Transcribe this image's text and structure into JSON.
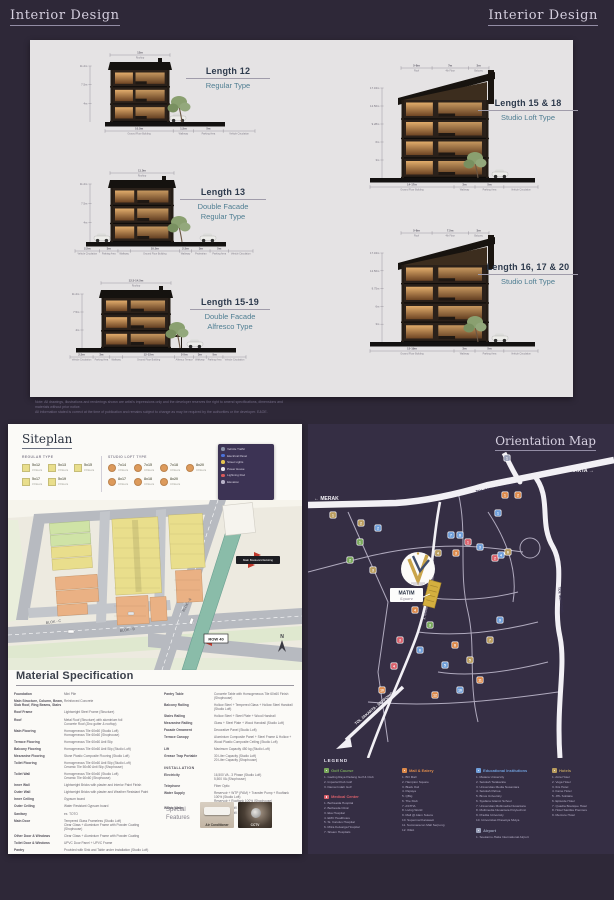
{
  "page": {
    "header_left": "Interior Design",
    "header_right": "Interior Design"
  },
  "interior": {
    "sections": [
      {
        "id": "length-12",
        "title": "Length 12",
        "subtitle": "Regular Type",
        "floors": 3,
        "style": "regular",
        "top_dims": [
          {
            "v": "12m",
            "l": "Rooftop",
            "w": 1
          }
        ],
        "heights": [
          "11.2m",
          "7.5m",
          "4m"
        ],
        "bottom_dims": [
          {
            "v": "10.5m",
            "l": "Ground Floor Building",
            "w": 3
          },
          {
            "v": "1.5m",
            "l": "Walkway",
            "w": 0.9
          },
          {
            "v": "5m",
            "l": "Parking Area",
            "w": 1.3
          },
          {
            "v": "",
            "l": "Vehicle Circulation",
            "w": 1.4
          }
        ]
      },
      {
        "id": "length-13",
        "title": "Length 13",
        "subtitle": "Double Facade\nRegular Type",
        "floors": 3,
        "style": "double",
        "top_dims": [
          {
            "v": "11.5m",
            "l": "Rooftop",
            "w": 1
          }
        ],
        "heights": [
          "11.2m",
          "7.5m",
          "4m"
        ],
        "bottom_dims": [
          {
            "v": "2.5m",
            "l": "Vehicle Circulation",
            "w": 1.2
          },
          {
            "v": "3m",
            "l": "Parking Area",
            "w": 0.9
          },
          {
            "v": "",
            "l": "Walkway",
            "w": 0.6
          },
          {
            "v": "10.5m",
            "l": "Ground Floor Building",
            "w": 2.4
          },
          {
            "v": "2.5m",
            "l": "Walkway",
            "w": 0.6
          },
          {
            "v": "3m",
            "l": "Pedestrian",
            "w": 0.9
          },
          {
            "v": "5m",
            "l": "Parking Area",
            "w": 0.9
          },
          {
            "v": "",
            "l": "Vehicle Circulation",
            "w": 1.2
          }
        ]
      },
      {
        "id": "length-15-19",
        "title": "Length 15-19",
        "subtitle": "Double Facade\nAlfresco Type",
        "floors": 3,
        "style": "alfresco",
        "top_dims": [
          {
            "v": "12.5-14.5m",
            "l": "Rooftop",
            "w": 1
          }
        ],
        "heights": [
          "11.2m",
          "7.5m",
          "4m"
        ],
        "bottom_dims": [
          {
            "v": "2.5m",
            "l": "Vehicle Circulation",
            "w": 1.1
          },
          {
            "v": "3m",
            "l": "Parking Area",
            "w": 0.8
          },
          {
            "v": "",
            "l": "Walkway",
            "w": 0.6
          },
          {
            "v": "12-15m",
            "l": "Ground Floor Building",
            "w": 2.5
          },
          {
            "v": "2-5m",
            "l": "Alfresco Terrace",
            "w": 0.9
          },
          {
            "v": "3m",
            "l": "Walkway",
            "w": 0.6
          },
          {
            "v": "5m",
            "l": "Parking Area",
            "w": 0.8
          },
          {
            "v": "",
            "l": "Vehicle Circulation",
            "w": 1.1
          }
        ]
      },
      {
        "id": "length-15-18",
        "title": "Length 15 & 18",
        "subtitle": "Studio Loft Type",
        "floors": 4,
        "style": "studio",
        "top_dims": [
          {
            "v": "5-8m",
            "l": "Roof",
            "w": 1.2
          },
          {
            "v": "7m",
            "l": "4th Floor",
            "w": 1.4
          },
          {
            "v": "3m",
            "l": "Balcony",
            "w": 0.8
          }
        ],
        "heights": [
          "17.34m",
          "12.56m",
          "9.28m",
          "6m",
          "3m"
        ],
        "bottom_dims": [
          {
            "v": "14-17m",
            "l": "Ground Floor Building",
            "w": 3.2
          },
          {
            "v": "3m",
            "l": "Walkway",
            "w": 0.8
          },
          {
            "v": "5m",
            "l": "Parking Area",
            "w": 1.1
          },
          {
            "v": "",
            "l": "Vehicle Circulation",
            "w": 1.3
          }
        ]
      },
      {
        "id": "length-16-17-20",
        "title": "Length 16, 17 & 20",
        "subtitle": "Studio Loft Type",
        "floors": 4,
        "style": "studio",
        "top_dims": [
          {
            "v": "5-8m",
            "l": "Roof",
            "w": 1.2
          },
          {
            "v": "7.5m",
            "l": "4th Floor",
            "w": 1.4
          },
          {
            "v": "3m",
            "l": "Balcony",
            "w": 0.8
          }
        ],
        "heights": [
          "17.34m",
          "12.56m",
          "9.75m",
          "6m",
          "3m"
        ],
        "bottom_dims": [
          {
            "v": "15-19m",
            "l": "Ground Floor Building",
            "w": 3.2
          },
          {
            "v": "3m",
            "l": "Walkway",
            "w": 0.8
          },
          {
            "v": "5m",
            "l": "Parking Area",
            "w": 1.1
          },
          {
            "v": "",
            "l": "Vehicle Circulation",
            "w": 1.3
          }
        ]
      }
    ],
    "disclaimer": "Note: All drawings, illustrations and renderings shown are artist's impressions only and the developer reserves the right to amend specifications, dimensions and materials without prior notice.\nAll information stated is correct at the time of publication and remains subject to change as may be required by the authorities or the developer. E&OE."
  },
  "siteplan": {
    "title": "Siteplan",
    "regular_type": {
      "label": "REGULAR TYPE",
      "color": "#e9de8c",
      "items": [
        {
          "code": "5x12",
          "floors": "3 Floors"
        },
        {
          "code": "5x13",
          "floors": "3 Floors"
        },
        {
          "code": "5x15",
          "floors": "3 Floors"
        },
        {
          "code": "5x17",
          "floors": "3 Floors"
        },
        {
          "code": "5x19",
          "floors": "3 Floors"
        }
      ]
    },
    "studio_type": {
      "label": "STUDIO LOFT TYPE",
      "color": "#dd9a5b",
      "items": [
        {
          "code": "7x14",
          "floors": "4 Floors"
        },
        {
          "code": "7x15",
          "floors": "4 Floors"
        },
        {
          "code": "7x18",
          "floors": "4 Floors"
        },
        {
          "code": "8x20",
          "floors": "4 Floors"
        },
        {
          "code": "8x17",
          "floors": "4 Floors"
        },
        {
          "code": "8x18",
          "floors": "4 Floors"
        },
        {
          "code": "8x20",
          "floors": "4 Floors"
        }
      ]
    },
    "site_key": [
      {
        "label": "Vehicle Traffic",
        "color": "#8a93a8"
      },
      {
        "label": "Electrical Panel",
        "color": "#4a72d8"
      },
      {
        "label": "Street Lights",
        "color": "#e5c44f"
      },
      {
        "label": "Power House",
        "color": "#e8e6ee"
      },
      {
        "label": "Lightning Rod",
        "color": "#d85a5a"
      },
      {
        "label": "Elevation",
        "color": "#b8b2c8"
      }
    ],
    "map_labels": {
      "blok_a": "BLOK - A",
      "blok_b": "BLOK - B",
      "blok_c": "BLOK - C",
      "row": "ROW 40",
      "boulevard": "Main Boulevard Existing",
      "north": "N"
    }
  },
  "material_spec": {
    "title": "Material Specification",
    "left_rows": [
      {
        "label": "Foundation",
        "value": "Mini Pile"
      },
      {
        "label": "Main Structure, Column, Beam, Slab Roof, Ring Beams, Stairs",
        "value": "Reinforced Concrete"
      },
      {
        "label": "Roof Frame",
        "value": "Lightweight Steel Frame (Structure)"
      },
      {
        "label": "Roof",
        "value": "Metal Roof (Structure) with aluminium foil\nConcrete Roof (Zinc gutter & rooftop)"
      },
      {
        "label": "Main Flooring",
        "value": "Homogeneous Tile 60x60 (Studio Loft)\nHomogeneous Tile 60x60 (Shophouse)"
      },
      {
        "label": "Terrace Flooring",
        "value": "Homogeneous Tile 60x60 Anti Slip"
      },
      {
        "label": "Balcony Flooring",
        "value": "Homogeneous Tile 60x60 Anti Slip (Studio Loft)"
      },
      {
        "label": "Mezzanine Flooring",
        "value": "Stone Plastic Composite Flooring (Studio Loft)"
      },
      {
        "label": "Toilet Flooring",
        "value": "Homogeneous Tile 60x60 Anti Slip (Studio Loft)\nCeramic Tile 50x50 Anti Slip (Shophouse)"
      },
      {
        "label": "Toilet Wall",
        "value": "Homogeneous Tile 60x60 (Studio Loft)\nCeramic Tile 60x60 (Shophouse)"
      },
      {
        "label": "Inner Wall",
        "value": "Lightweight Bricks with plaster and Interior Paint Finish"
      },
      {
        "label": "Outer Wall",
        "value": "Lightweight Bricks with plaster and Weather Resistant Paint"
      },
      {
        "label": "Inner Ceiling",
        "value": "Gypsum board"
      },
      {
        "label": "Outer Ceiling",
        "value": "Water Resistant Gypsum board"
      },
      {
        "label": "Sanitary",
        "value": "ex. TOTO"
      },
      {
        "label": "Main Door",
        "value": "Tempered Glass Frameless (Studio Loft)\nClear Glass + Aluminium Frame with Powder Coating (Shophouse)"
      },
      {
        "label": "Other Door & Windows",
        "value": "Clear Glass + Aluminium Frame with Powder Coating"
      },
      {
        "label": "Toilet Door & Windows",
        "value": "UPVC Door Panel + UPVC Frame"
      },
      {
        "label": "Pantry",
        "value": "Provided with Sink and Table under Installation (Studio Loft)"
      }
    ],
    "right_rows": [
      {
        "label": "Pantry Table",
        "value": "Concrete Table with Homogeneous Tile 60x60 Finish (Shophouse)"
      },
      {
        "label": "Balcony Railing",
        "value": "Hollow Steel + Tempered Glass + Hollow Steel Handrail (Studio Loft)"
      },
      {
        "label": "Stairs Railing",
        "value": "Hollow Steel + Steel Plate + Wood Handrail"
      },
      {
        "label": "Mezzanine Railing",
        "value": "Glass + Steel Plate + Wood Handrail (Studio Loft)"
      },
      {
        "label": "Facade Ornament",
        "value": "Decorative Panel (Studio Loft)"
      },
      {
        "label": "Terrace Canopy",
        "value": "Aluminium Composite Panel + Steel Frame & Hollow + Wood Plastic Composite Ceiling (Studio Loft)"
      },
      {
        "label": "Lift",
        "value": "Maximum Capacity 450 kg (Studio Loft)"
      },
      {
        "label": "Grease Trap Portable",
        "value": "30 Liter Capacity (Studio Loft)\n20 Liter Capacity (Shophouse)"
      },
      {
        "header": "INSTALLATION"
      },
      {
        "label": "Electricity",
        "value": "16,500 VA - 3 Phase (Studio Loft)\n5,500 VA (Shophouse)"
      },
      {
        "label": "Telephone",
        "value": "Fiber Optic"
      },
      {
        "label": "Water Supply",
        "value": "Reservoir + WTP (PAM) + Transfer Pump + Rooftank 100% (Studio Loft)\nReservoir + Rooftank 100% (Shophouse)"
      },
      {
        "label": "Waste Water",
        "value": "Septictank Biofil 100% (Studio Loft)\nSeptictank Biofil 100% (Shophouse)"
      }
    ],
    "special": {
      "label": "Special Features",
      "items": [
        {
          "caption": "Air Conditioner"
        },
        {
          "caption": "CCTV"
        }
      ]
    }
  },
  "orientation": {
    "title": "Orientation Map",
    "road_labels": {
      "merak": "← MERAK",
      "jakarta": "JAKARTA →",
      "tol_main": "TOL JAKARTA - MERAK",
      "tol_right": "TOL SERPONG",
      "tol_bottom": "TOL JAKARTA - SERPONG",
      "boulevard": "JL. GADING SERPONG BOULEVARD"
    },
    "site": {
      "name": "MATIM",
      "sub": "Square"
    },
    "legend_title": "LEGEND",
    "pin_colors": {
      "golf": "#79a85c",
      "med": "#d9606b",
      "mall": "#dd8a4b",
      "edu": "#6f9ed9",
      "hotel": "#b99c5e",
      "misc": "#9aa0b8"
    },
    "pins": [
      {
        "x": 25,
        "y": 63,
        "c": "hotel",
        "n": "1"
      },
      {
        "x": 53,
        "y": 71,
        "c": "hotel",
        "n": "2"
      },
      {
        "x": 70,
        "y": 76,
        "c": "edu",
        "n": "2"
      },
      {
        "x": 52,
        "y": 90,
        "c": "golf",
        "n": "1"
      },
      {
        "x": 65,
        "y": 118,
        "c": "hotel",
        "n": "3"
      },
      {
        "x": 42,
        "y": 108,
        "c": "golf",
        "n": "2"
      },
      {
        "x": 130,
        "y": 101,
        "c": "hotel",
        "n": "4"
      },
      {
        "x": 143,
        "y": 83,
        "c": "edu",
        "n": "7"
      },
      {
        "x": 152,
        "y": 83,
        "c": "edu",
        "n": "8"
      },
      {
        "x": 148,
        "y": 101,
        "c": "mall",
        "n": "3"
      },
      {
        "x": 160,
        "y": 90,
        "c": "med",
        "n": "1"
      },
      {
        "x": 172,
        "y": 95,
        "c": "edu",
        "n": "3"
      },
      {
        "x": 187,
        "y": 106,
        "c": "med",
        "n": "2"
      },
      {
        "x": 193,
        "y": 103,
        "c": "edu",
        "n": "4"
      },
      {
        "x": 200,
        "y": 100,
        "c": "hotel",
        "n": "6"
      },
      {
        "x": 190,
        "y": 61,
        "c": "edu",
        "n": "1"
      },
      {
        "x": 197,
        "y": 43,
        "c": "mall",
        "n": "1"
      },
      {
        "x": 210,
        "y": 43,
        "c": "mall",
        "n": "2"
      },
      {
        "x": 199,
        "y": 6,
        "c": "misc",
        "n": "1"
      },
      {
        "x": 107,
        "y": 158,
        "c": "mall",
        "n": "4"
      },
      {
        "x": 122,
        "y": 173,
        "c": "golf",
        "n": "3"
      },
      {
        "x": 147,
        "y": 193,
        "c": "mall",
        "n": "8"
      },
      {
        "x": 162,
        "y": 208,
        "c": "hotel",
        "n": "5"
      },
      {
        "x": 137,
        "y": 213,
        "c": "edu",
        "n": "5"
      },
      {
        "x": 172,
        "y": 228,
        "c": "mall",
        "n": "11"
      },
      {
        "x": 112,
        "y": 198,
        "c": "edu",
        "n": "6"
      },
      {
        "x": 92,
        "y": 188,
        "c": "med",
        "n": "3"
      },
      {
        "x": 152,
        "y": 238,
        "c": "edu",
        "n": "10"
      },
      {
        "x": 182,
        "y": 188,
        "c": "hotel",
        "n": "7"
      },
      {
        "x": 192,
        "y": 168,
        "c": "edu",
        "n": "9"
      },
      {
        "x": 127,
        "y": 243,
        "c": "mall",
        "n": "12"
      },
      {
        "x": 86,
        "y": 214,
        "c": "med",
        "n": "4"
      },
      {
        "x": 74,
        "y": 238,
        "c": "mall",
        "n": "10"
      }
    ],
    "legend_columns": [
      [
        {
          "name": "Golf Course",
          "color": "#79a85c",
          "items": [
            "Gading Raya Padang Golf & Club",
            "Imperial Klub Golf",
            "Damai Indah Golf"
          ]
        },
        {
          "name": "Medical Center",
          "color": "#d9606b",
          "items": [
            "Bethsaida Hospital",
            "Bethesda Clinic",
            "Eka Hospital",
            "EMC Healthcare",
            "St. Carolus Hospital",
            "Mitra Keluarga Hospital",
            "Siloam Hospitals"
          ]
        }
      ],
      [
        {
          "name": "Mall & Eatery",
          "color": "#dd8a4b",
          "items": [
            "BO Mall",
            "Hampton Square",
            "Black Owl",
            "Papaya",
            "QBig",
            "The Klub",
            "ASTHA",
            "Living World",
            "Mall @ Alam Sutera",
            "Supermal Karawaci",
            "Summarecon Mall Serpong",
            "IKEA"
          ]
        }
      ],
      [
        {
          "name": "Educational Institutions",
          "color": "#6f9ed9",
          "items": [
            "Matana University",
            "Sekolah Tarakanita",
            "Universitas Media Nusantara",
            "Sekolah Pahoa",
            "Binus University",
            "Syafana Islamic School",
            "Universitas Multimedia Nusantara",
            "Multimedia Nusantara Polytechnic",
            "Pradita University",
            "Universitas Prasetiya Mulya"
          ]
        },
        {
          "name": "Airport",
          "color": "#9aa0b8",
          "items": [
            "Soekarno-Hatta International Airport"
          ]
        }
      ],
      [
        {
          "name": "Hotels",
          "color": "#b99c5e",
          "items": [
            "Atria Hotel",
            "Vega Hotel",
            "Ibis Hotel",
            "Fame Hotel",
            "JHL Solitaire",
            "Episode Hotel",
            "Quadra Boutique Hotel",
            "Hotel Santika Premiere",
            "Mercure Hotel"
          ]
        }
      ]
    ]
  }
}
